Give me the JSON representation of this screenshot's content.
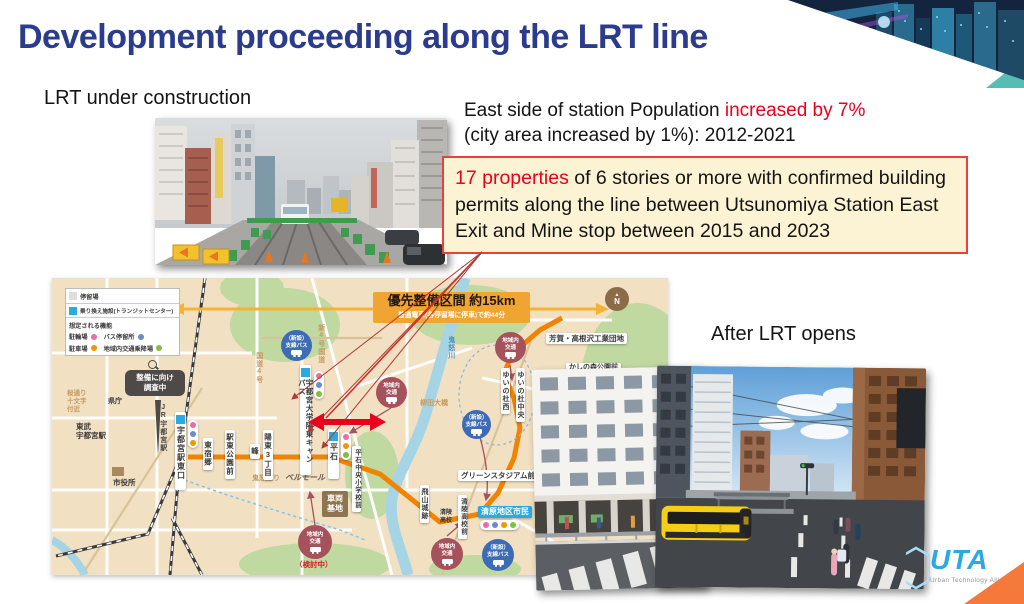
{
  "header": {
    "title": "Development proceeding along the LRT line"
  },
  "labels": {
    "construction": "LRT under construction",
    "after": "After LRT opens"
  },
  "population": {
    "prefix": "East side of station Population ",
    "highlight": "increased by 7%",
    "line2": "(city area increased by 1%): 2012-2021"
  },
  "permits": {
    "highlight": "17 properties",
    "rest": " of 6 stories or more with confirmed building permits along the line between Utsunomiya Station East Exit and Mine stop between 2015 and 2023"
  },
  "map": {
    "banner": {
      "title": "優先整備区間 約15km",
      "subtitle": "普通電車(各停留場に停車)で約44分"
    },
    "legend": {
      "stop": "停留場",
      "transit": "乗り換え施設(トランジットセンター)",
      "functions_title": "想定される機能",
      "bicycle_parking": "駐輪場",
      "bus_stop": "バス停留所",
      "car_parking": "駐車場",
      "local_boarding": "地域内交通乗降場"
    },
    "survey_bubble": "整備に向け\n調査中",
    "north_label": "N",
    "badges": {
      "local_transit": "地域内\n交通",
      "branch_bus": "（新設）\n支線バス",
      "pending": "（検討中）"
    },
    "stations": {
      "west_exit": "宇都宮駅東口",
      "higashi_shukugo": "東宿郷",
      "ekihigashi_koen": "駅東公園前",
      "mine": "峰",
      "yoto_3chome": "陽東3丁目",
      "univ_campus": "宇都宮大学陽東キャンパス",
      "hiraishi": "平石",
      "hiraishi_chuo_shogakko": "平石中央小学校前",
      "tobiyama_joseki": "飛山城跡",
      "seiryo_kokomae": "清陵高校前",
      "kiyohara_chiku_shimin": "清原地区市民",
      "green_stadium_mae": "グリーンスタジアム前",
      "yuinomori_nishi": "ゆいの杜西",
      "yuinomori_chuo": "ゆいの杜中央",
      "kashinomori_koen_mae": "かしの森公園前",
      "haga_takanezawa": "芳賀・高根沢工業団地"
    },
    "places": {
      "tobu_utsunomiya": "東武\n宇都宮駅",
      "jr_utsunomiya": "JR宇都宮駅",
      "city_hall": "市役所",
      "kencho": "県庁",
      "sakura_dori": "桜通り\n十文字\n付近",
      "route4": "国道4号",
      "shin_route4": "新4号国道",
      "kinu_dori": "鬼怒通り",
      "bell_mall": "ベルモール",
      "depot": "車両\n基地",
      "yanagida_bridge": "柳田大橋",
      "kinugawa": "鬼怒川",
      "seiryo_koko": "清陵\n高校"
    }
  },
  "logo": {
    "acronym": "UTA",
    "tagline": "Urban Technology Alliance"
  },
  "colors": {
    "title_navy": "#2C3C8C",
    "highlight_red": "#E8001D",
    "box_bg": "#FCF3D4",
    "box_border": "#E8413C",
    "map_bg": "#F2E0C2",
    "route_orange": "#F08300",
    "legend_cyan": "#29ABE2",
    "banner_orange": "#F0A432",
    "dot_pink": "#EA6DA4",
    "dot_blue": "#6C8CC8",
    "dot_orange": "#F29600",
    "dot_green": "#7FBE41",
    "logo_blue": "#2BA9E1",
    "corner_orange": "#F4793B",
    "teal_accent": "#56BDB2"
  }
}
